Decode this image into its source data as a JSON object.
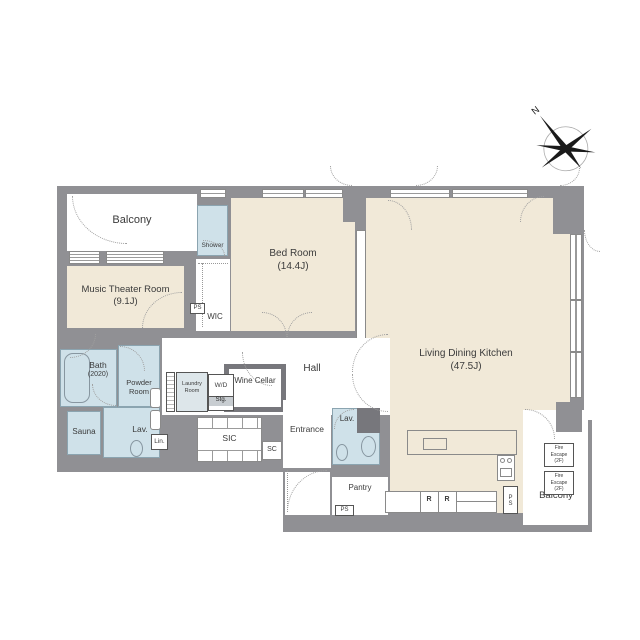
{
  "colors": {
    "wall": "#909094",
    "room_beige": "#f1e9d8",
    "room_blue": "#cfe1e9",
    "wall_dark": "#77777c"
  },
  "compass": {
    "north": "N"
  },
  "rooms": {
    "balcony_north": {
      "name": "Balcony"
    },
    "music_theater_room": {
      "name": "Music Theater Room",
      "size": "(9.1J)"
    },
    "shower": {
      "name": "Shower"
    },
    "wic": {
      "name": "WIC"
    },
    "bed_room": {
      "name": "Bed Room",
      "size": "(14.4J)"
    },
    "living_dining_kitchen": {
      "name": "Living Dining Kitchen",
      "size": "(47.5J)"
    },
    "hall": {
      "name": "Hall"
    },
    "bath": {
      "name": "Bath",
      "size": "(2020)"
    },
    "powder_room": {
      "name": "Powder Room"
    },
    "sauna": {
      "name": "Sauna"
    },
    "lavatory_west": {
      "name": "Lav."
    },
    "linen": {
      "name": "Lin."
    },
    "laundry_room": {
      "name": "Laundry Room"
    },
    "wd_storage": {
      "top": "W/D",
      "bottom": "Stg."
    },
    "wine_cellar": {
      "name": "Wine Cellar"
    },
    "sic": {
      "name": "SIC"
    },
    "shoe_closet": {
      "name": "SC"
    },
    "entrance": {
      "name": "Entrance"
    },
    "lavatory_east": {
      "name": "Lav."
    },
    "pantry": {
      "name": "Pantry"
    },
    "balcony_south": {
      "name": "Balcony"
    }
  },
  "labels": {
    "ps_wic": "PS",
    "ps_pantry": "PS",
    "ps_kitchen": "PS",
    "refrigerator_1": "R",
    "refrigerator_2": "R",
    "fire_escape": {
      "l1": "Fire",
      "l2": "Escape",
      "l3": "(2F)"
    }
  }
}
